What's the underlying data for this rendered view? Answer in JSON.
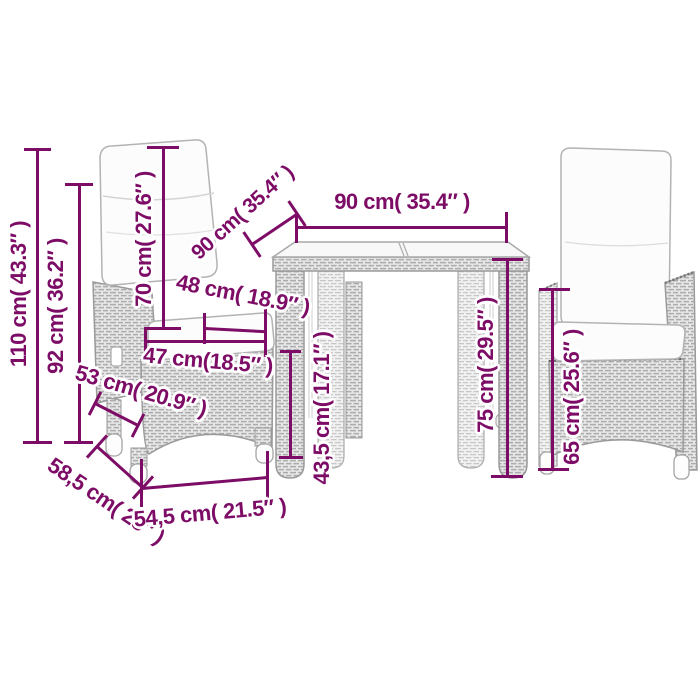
{
  "style": {
    "dimension_color": "#7d0c66",
    "background_color": "#ffffff",
    "wicker_fill": "#e7e7e7",
    "cushion_fill": "#fcfcfc"
  },
  "labels": {
    "chair_total_height": "110 cm( 43.3″ )",
    "chair_back_height": "92 cm( 36.2″ )",
    "backrest_cushion_height": "70 cm( 27.6″ )",
    "table_depth": "90 cm( 35.4″ )",
    "table_width": "90 cm( 35.4″ )",
    "seat_width_inner": "48 cm( 18.9″ )",
    "seat_width_front": "47 cm(18.5″ )",
    "seat_depth": "53 cm( 20.9″ )",
    "chair_depth": "58,5 cm( 23″ )",
    "chair_width": "54,5 cm( 21.5″ )",
    "seat_height": "43,5 cm( 17.1″ )",
    "table_height": "75 cm( 29.5″ )",
    "armrest_height": "65 cm( 25.6″ )"
  }
}
